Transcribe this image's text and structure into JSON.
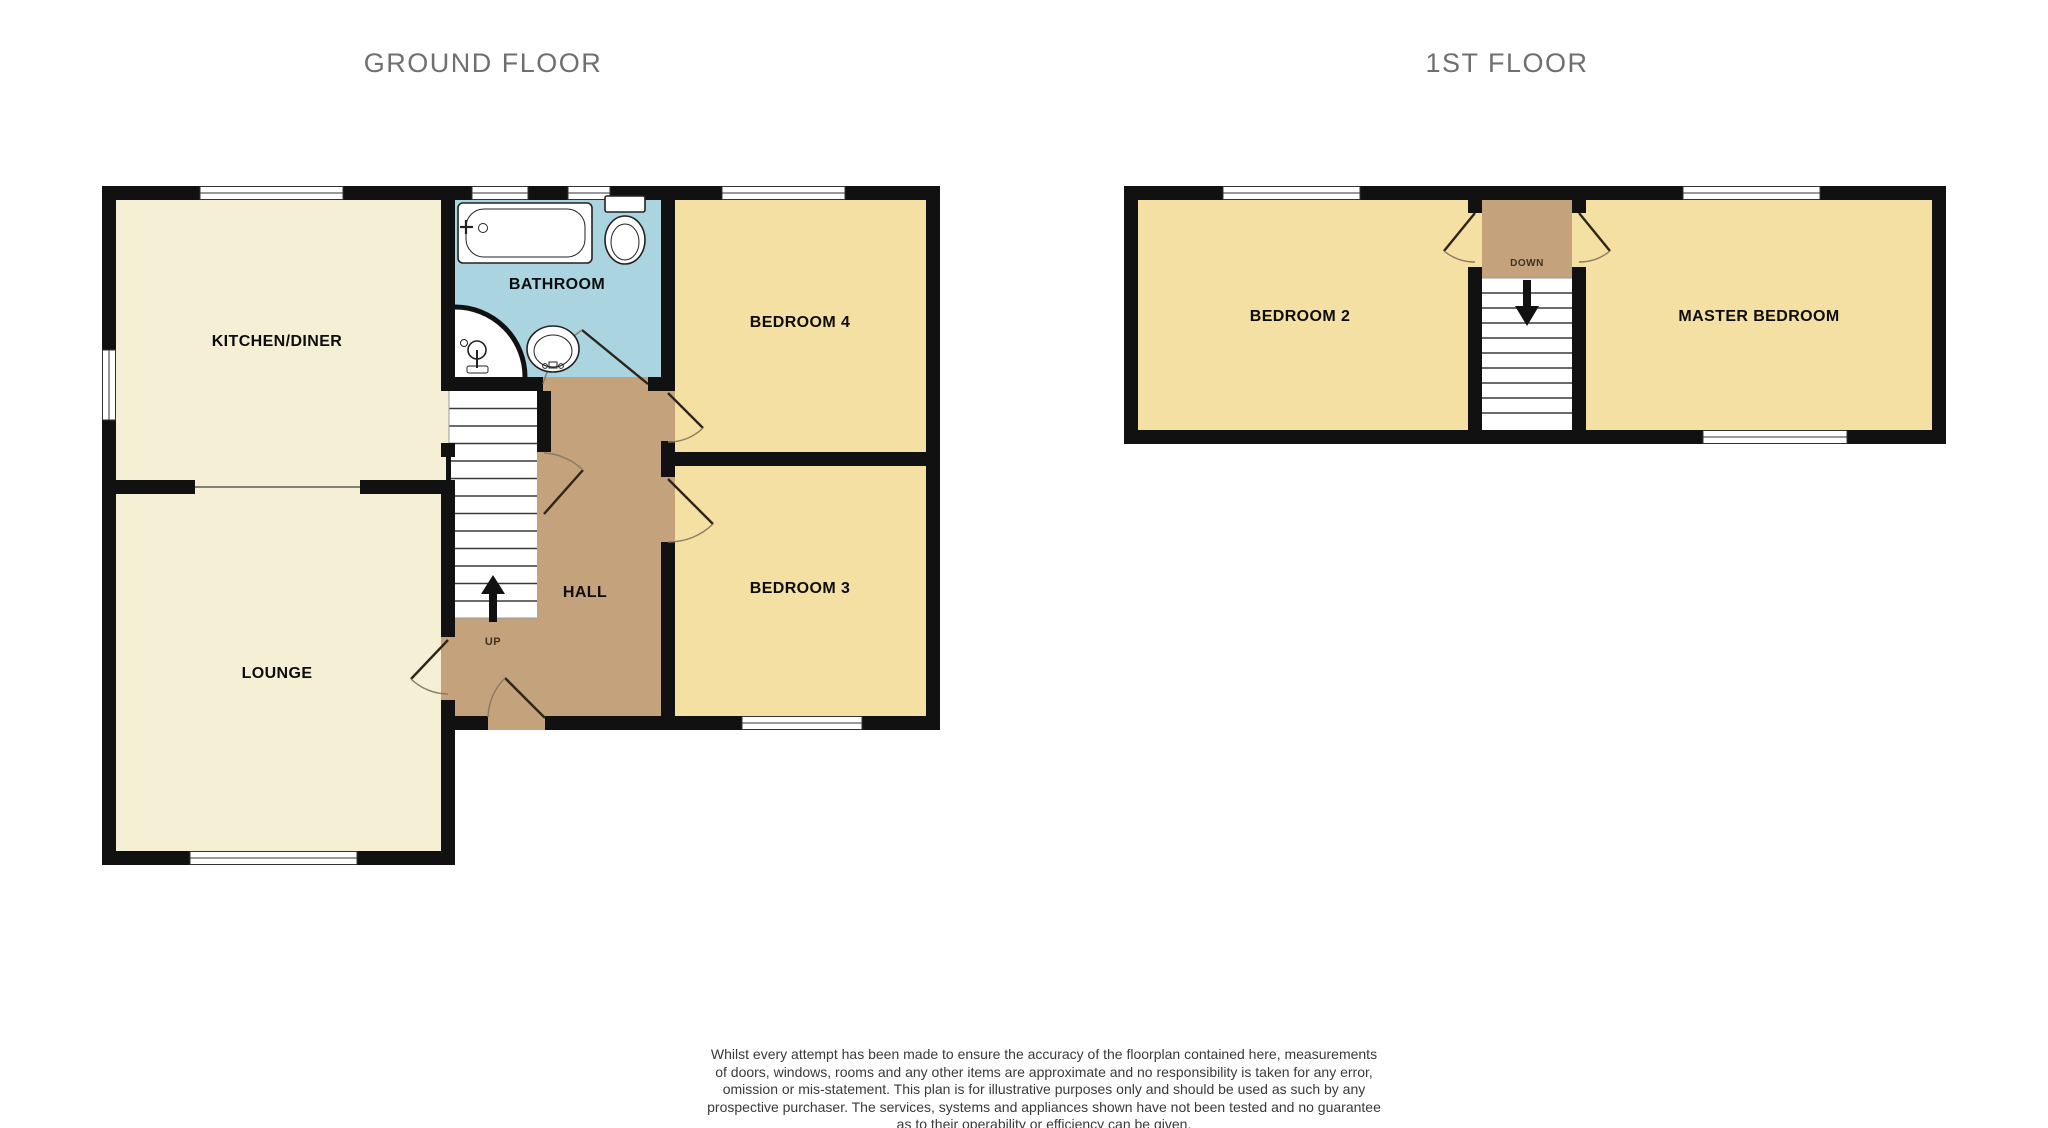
{
  "floorplan": {
    "ground_floor": {
      "title": "GROUND FLOOR",
      "rooms": {
        "kitchen": "KITCHEN/DINER",
        "bathroom": "BATHROOM",
        "bedroom4": "BEDROOM 4",
        "bedroom3": "BEDROOM 3",
        "hall": "HALL",
        "lounge": "LOUNGE"
      },
      "stair_direction": "UP"
    },
    "first_floor": {
      "title": "1ST FLOOR",
      "rooms": {
        "bedroom2": "BEDROOM 2",
        "master": "MASTER BEDROOM"
      },
      "stair_direction": "DOWN"
    },
    "colors": {
      "wall": "#111111",
      "room_cream": "#f5efd5",
      "room_yellow": "#f3e0a2",
      "room_blue": "#aad5e0",
      "hall_tan": "#c4a37c",
      "stair_white": "#ffffff",
      "title_text": "#6f6f6f"
    }
  },
  "disclaimer": {
    "lines": [
      "Whilst every attempt has been made to ensure the accuracy of the floorplan contained here, measurements",
      "of doors, windows, rooms and any other items are approximate and no responsibility is taken for any error,",
      "omission or mis-statement. This plan is for illustrative purposes only and should be used as such by any",
      "prospective purchaser. The services, systems and appliances shown have not been tested and no guarantee",
      "as to their operability or efficiency can be given.",
      "Made with Metropix ©2022"
    ]
  }
}
